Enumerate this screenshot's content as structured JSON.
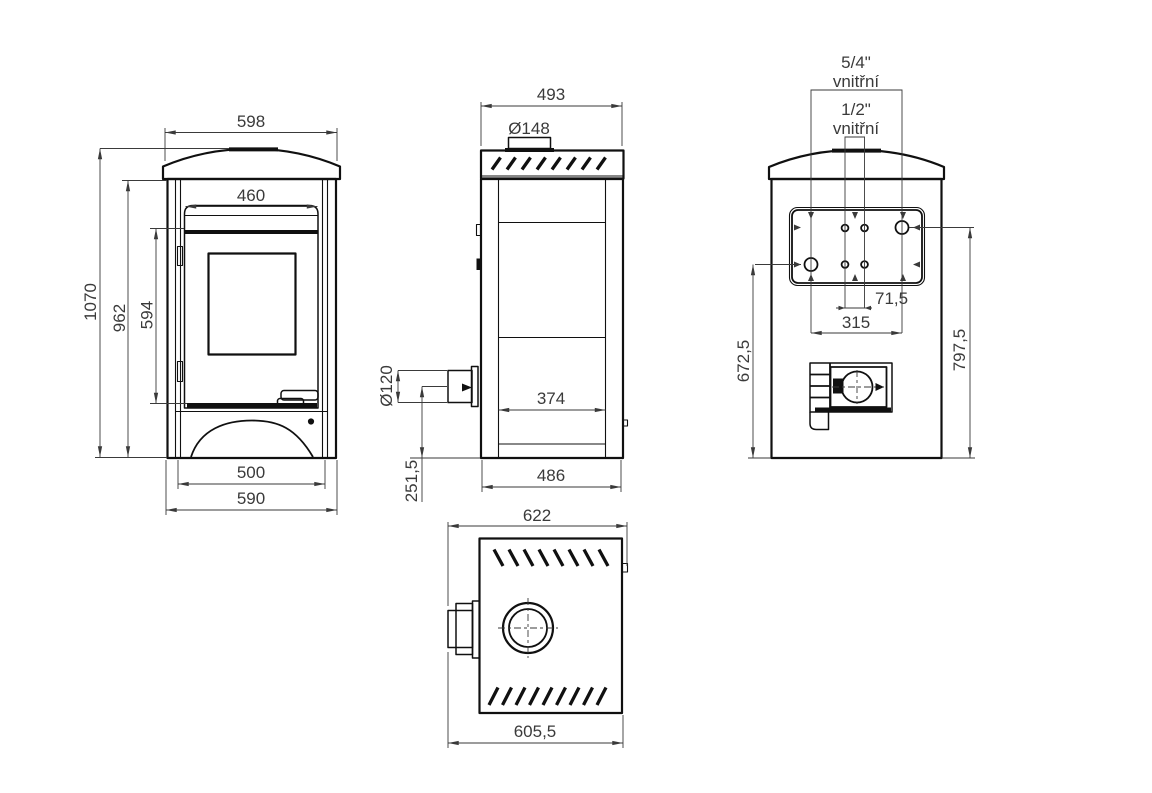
{
  "colors": {
    "line": "#101010",
    "dimension": "#3a3a3a",
    "background": "#ffffff"
  },
  "views": {
    "front": {
      "dims": {
        "top_width": "598",
        "door_width": "460",
        "overall_height": "1070",
        "body_height": "962",
        "door_height": "594",
        "base_inner_width": "500",
        "base_width": "590"
      }
    },
    "side": {
      "dims": {
        "depth": "493",
        "collar_diameter": "Ø148",
        "rear_flue_diameter": "Ø120",
        "inner_depth": "374",
        "rear_flue_center_height": "251,5",
        "base_depth": "486"
      }
    },
    "back": {
      "labels": {
        "large_fitting_size": "5/4\"",
        "large_fitting_type": "vnitřní",
        "small_fitting_size": "1/2\"",
        "small_fitting_type": "vnitřní"
      },
      "dims": {
        "small_fitting_spacing": "71,5",
        "large_fitting_spacing": "315",
        "left_fitting_height": "672,5",
        "right_fitting_height": "797,5"
      }
    },
    "top": {
      "dims": {
        "overall_depth": "622",
        "body_depth": "605,5"
      }
    }
  }
}
